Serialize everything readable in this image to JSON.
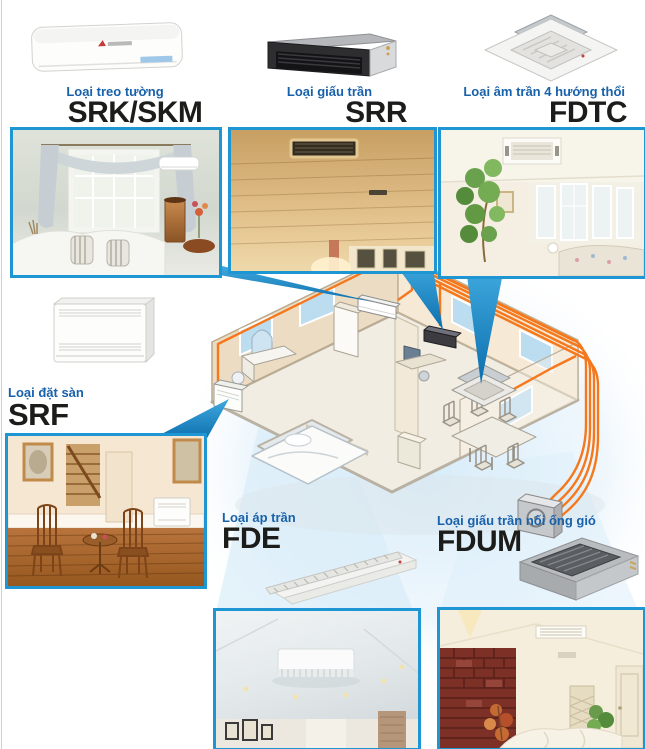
{
  "page": {
    "type": "air-conditioner-lineup-brochure",
    "background": "#ffffff",
    "accent_label_color": "#1861ab",
    "photo_border_color": "#1e96d3",
    "pipe_color": "#f5781c",
    "pointer_color": "#1b85c4",
    "model_text_color": "#1c1c1a"
  },
  "products": [
    {
      "label": "Loại treo tường",
      "model": "SRK/SKM",
      "icon": "wall-mounted-unit-icon"
    },
    {
      "label": "Loại giấu trần",
      "model": "SRR",
      "icon": "concealed-duct-unit-icon"
    },
    {
      "label": "Loại âm trần 4 hướng thổi",
      "model": "FDTC",
      "icon": "ceiling-cassette-unit-icon"
    },
    {
      "label": "Loại đặt sàn",
      "model": "SRF",
      "icon": "floor-standing-unit-icon"
    },
    {
      "label": "Loại áp trần",
      "model": "FDE",
      "icon": "ceiling-suspended-unit-icon"
    },
    {
      "label": "Loại giấu trần nối ống gió",
      "model": "FDUM",
      "icon": "ducted-unit-icon"
    }
  ],
  "photos": [
    {
      "scene": "living-room-with-wall-mounted-unit"
    },
    {
      "scene": "wooden-ceiling-with-duct-grille"
    },
    {
      "scene": "bright-room-with-ceiling-cassette"
    },
    {
      "scene": "wood-floor-room-with-floor-standing-unit"
    },
    {
      "scene": "hall-ceiling-with-suspended-unit"
    },
    {
      "scene": "brick-accent-room-with-ceiling-grille"
    }
  ],
  "diagram": {
    "name": "isometric-house-multi-split-system",
    "elements": [
      "wall-mounted-indoor-unit",
      "concealed-duct-indoor-unit",
      "ceiling-cassette-indoor-unit",
      "floor-standing-indoor-unit",
      "outdoor-unit",
      "refrigerant-piping"
    ]
  }
}
